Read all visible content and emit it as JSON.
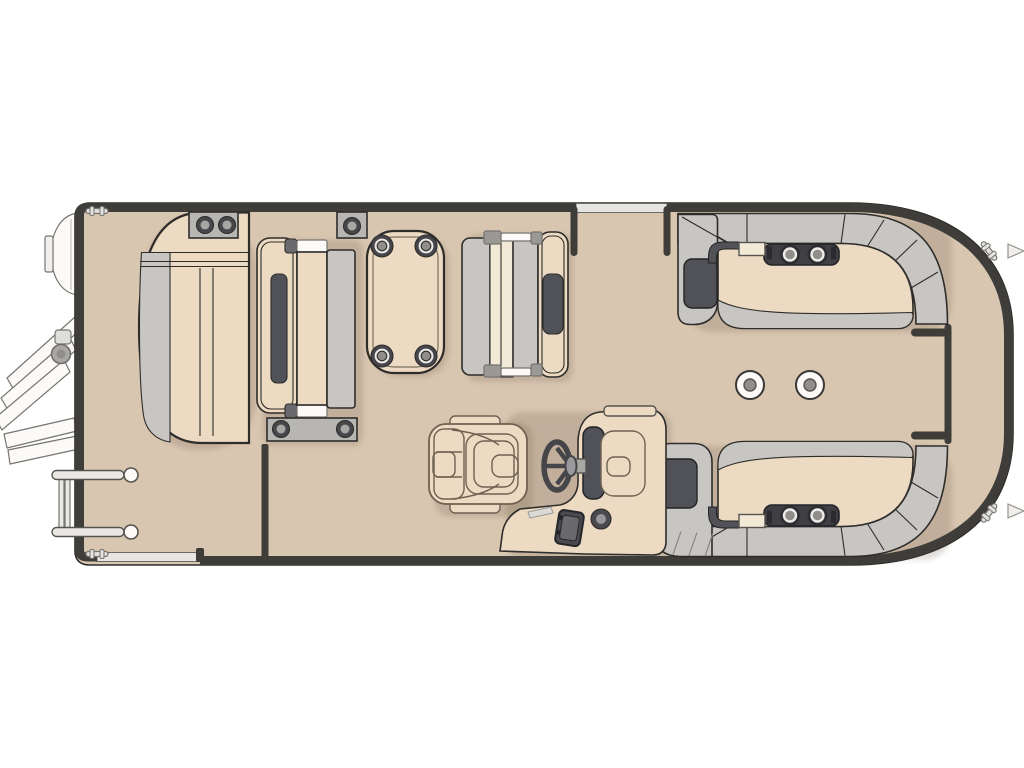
{
  "canvas": {
    "width": 1024,
    "height": 768,
    "background": "#ffffff"
  },
  "palette": {
    "background": "#ffffff",
    "deck": "#d8c6b0",
    "outline": "#2e2d2b",
    "fence": "#3f3d39",
    "cushion": "#ecdbc2",
    "cushionLight": "#f3e9d7",
    "grayCushion": "#c8c6c2",
    "plate": "#b7b6b2",
    "darkPad": "#515257",
    "metal": "#a8a7a3",
    "white": "#fbfaf8",
    "ring": "#edebe7",
    "knob": "#8f8e8b",
    "chairLine": "#6f6152",
    "railLight": "#e9e8e5",
    "wheel": "#45454a",
    "shadow": "rgba(96,78,56,0.18)"
  },
  "boat": {
    "type": "pontoon-floorplan-top-view",
    "components": [
      "hull-deck",
      "port-stern-gate",
      "top-gate-opening",
      "boarding-ladder",
      "motor-pod",
      "gate-grab-rails",
      "aft-chaise-lounge",
      "dinette-bench-left",
      "dinette-table-with-cupholders",
      "dinette-bench-right",
      "captain-chair",
      "helm-console",
      "steering-wheel",
      "bow-lounge-top",
      "bow-lounge-bottom",
      "armrest-cupholder-consoles",
      "floor-table-mounts",
      "bow-walkway-fence",
      "cleats",
      "bow-eyes"
    ]
  }
}
